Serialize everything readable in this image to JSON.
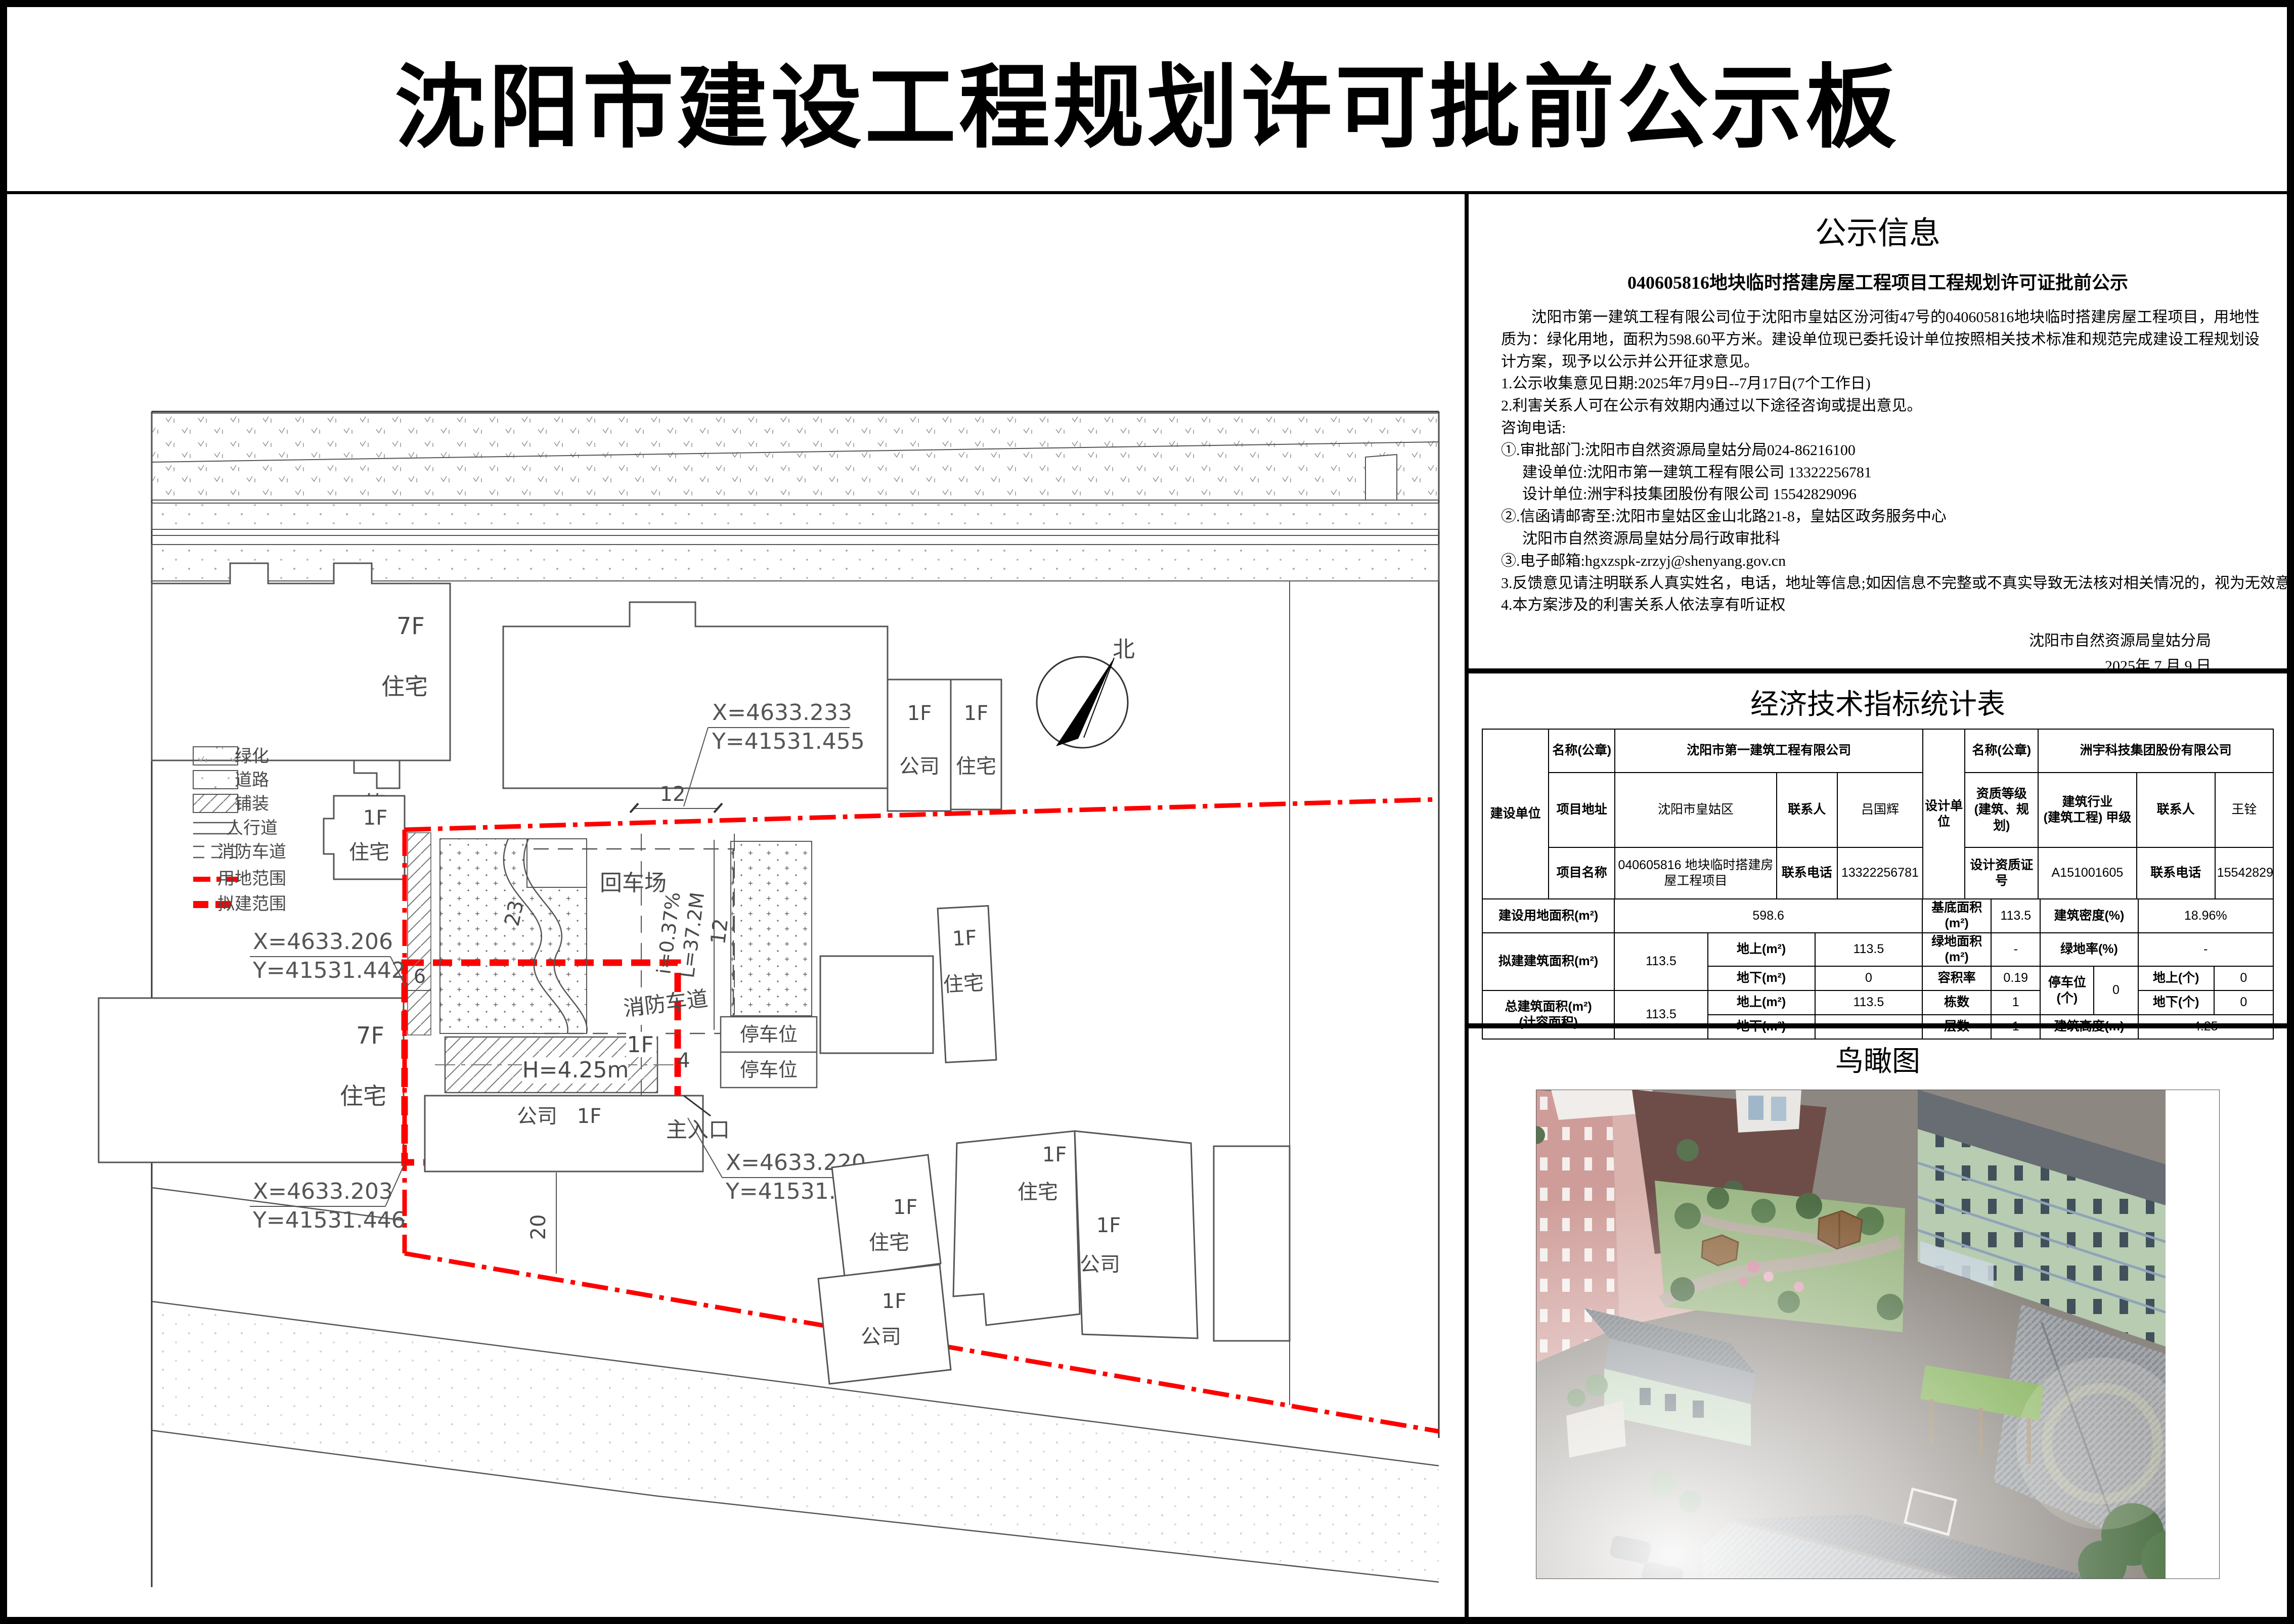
{
  "title": "沈阳市建设工程规划许可批前公示板",
  "notice": {
    "heading": "公示信息",
    "subtitle": "040605816地块临时搭建房屋工程项目工程规划许可证批前公示",
    "paragraph": "沈阳市第一建筑工程有限公司位于沈阳市皇姑区汾河街47号的040605816地块临时搭建房屋工程项目，用地性质为：绿化用地，面积为598.60平方米。建设单位现已委托设计单位按照相关技术标准和规范完成建设工程规划设计方案，现予以公示并公开征求意见。",
    "items": [
      {
        "t": "1.公示收集意见日期:2025年7月9日--7月17日(7个工作日)"
      },
      {
        "t": "2.利害关系人可在公示有效期内通过以下途径咨询或提出意见。"
      },
      {
        "t": "咨询电话:"
      },
      {
        "t": "①.审批部门:沈阳市自然资源局皇姑分局024-86216100"
      },
      {
        "t": "建设单位:沈阳市第一建筑工程有限公司  13322256781"
      },
      {
        "t": "设计单位:洲宇科技集团股份有限公司  15542829096"
      },
      {
        "t": "②.信函请邮寄至:沈阳市皇姑区金山北路21-8，皇姑区政务服务中心"
      },
      {
        "t": "沈阳市自然资源局皇姑分局行政审批科"
      },
      {
        "t": "③.电子邮箱:hgxzspk-zrzyj@shenyang.gov.cn"
      },
      {
        "t": "3.反馈意见请注明联系人真实姓名，电话，地址等信息;如因信息不完整或不真实导致无法核对相关情况的，视为无效意见。"
      },
      {
        "t": "4.本方案涉及的利害关系人依法享有听证权"
      }
    ],
    "signature_org": "沈阳市自然资源局皇姑分局",
    "signature_date": "2025年 7 月 9 日"
  },
  "stats": {
    "heading": "经济技术指标统计表",
    "unit_builder": "建设单位",
    "unit_designer": "设计单位",
    "seal_label": "名称(公章)",
    "builder_name": "沈阳市第一建筑工程有限公司",
    "designer_name": "洲宇科技集团股份有限公司",
    "addr_label": "项目地址",
    "addr": "沈阳市皇姑区",
    "contact_label": "联系人",
    "builder_contact": "吕国辉",
    "designer_contact": "王铨",
    "qual_label_1": "资质等级",
    "qual_label_2": "(建筑、规划)",
    "qual_1": "建筑行业",
    "qual_2": "(建筑工程) 甲级",
    "pname_label": "项目名称",
    "pname": "040605816 地块临时搭建房屋工程项目",
    "phone_label": "联系电话",
    "builder_phone": "13322256781",
    "cert_label": "设计资质证号",
    "cert": "A151001605",
    "designer_phone": "15542829096",
    "land_label": "建设用地面积(m²)",
    "land": "598.6",
    "base_label": "基底面积(m²)",
    "base": "113.5",
    "density_label": "建筑密度(%)",
    "density": "18.96%",
    "proposed_label": "拟建建筑面积(m²)",
    "proposed": "113.5",
    "above_label": "地上(m²)",
    "below_label": "地下(m²)",
    "above1": "113.5",
    "below1": "0",
    "green_label": "绿地面积(m²)",
    "green": "-",
    "greenrate_label": "绿地率(%)",
    "greenrate": "-",
    "far_label": "容积率",
    "far": "0.19",
    "parking_label": "停车位(个)",
    "parking": "0",
    "punit_above_label": "地上(个)",
    "punit_above": "0",
    "punit_below_label": "地下(个)",
    "punit_below": "0",
    "total_label_1": "总建筑面积(m²)",
    "total_label_2": "(计容面积)",
    "total": "113.5",
    "above2": "113.5",
    "count_label": "栋数",
    "count": "1",
    "floors_label": "层数",
    "floors": "1",
    "height_label": "建筑高度(m)",
    "height": "4.25"
  },
  "birdseye": {
    "heading": "鸟瞰图"
  },
  "siteplan": {
    "labels": {
      "f7": "7F",
      "f1": "1F",
      "f4": "4F",
      "res": "住宅",
      "company": "公司",
      "tong": "筒",
      "turnaround": "回车场",
      "fire_lane": "消防车道",
      "parking": "停车位",
      "entrance": "主入口",
      "bldg_height": "H=4.25m",
      "north": "北"
    },
    "dims": {
      "a": "12",
      "b": "23",
      "c": "6",
      "d": "4",
      "e": "20",
      "f": "12",
      "slope": "i=0.37%",
      "length": "L=37.2M"
    },
    "coords": [
      {
        "x": "X=4633.233",
        "y": "Y=41531.455"
      },
      {
        "x": "X=4633.206",
        "y": "Y=41531.442"
      },
      {
        "x": "X=4633.203",
        "y": "Y=41531.446"
      },
      {
        "x": "X=4633.220",
        "y": "Y=41531.459"
      }
    ],
    "legend": [
      {
        "label": "绿化"
      },
      {
        "label": "道路"
      },
      {
        "label": "铺装"
      },
      {
        "label": "人行道"
      },
      {
        "label": "消防车道"
      },
      {
        "label": "用地范围"
      },
      {
        "label": "拟建范围"
      }
    ]
  }
}
